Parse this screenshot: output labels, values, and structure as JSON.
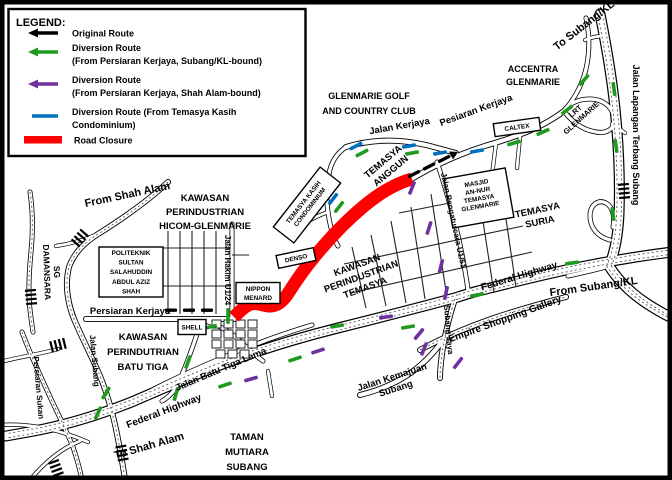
{
  "title": "Road Closure and Diversion Routes Map",
  "colors": {
    "original_route": "#000000",
    "diversion_subang_kl_bound": "#1F9A1F",
    "diversion_shah_alam_bound": "#7030A0",
    "diversion_temasya_kasih": "#0070C0",
    "road_closure": "#FF0000",
    "road_outline": "#000000",
    "background": "#FFFFFF"
  },
  "legend": {
    "heading": "LEGEND:",
    "items": [
      {
        "swatch": "black-arrow",
        "color": "#000000",
        "line1": "Original Route",
        "line2": ""
      },
      {
        "swatch": "green-arrow",
        "color": "#1F9A1F",
        "line1": "Diversion Route",
        "line2": "(From Persiaran Kerjaya, Subang/KL-bound)"
      },
      {
        "swatch": "purple-arrow",
        "color": "#7030A0",
        "line1": "Diversion Route",
        "line2": "(From Persiaran Kerjaya, Shah Alam-bound)"
      },
      {
        "swatch": "blue-line",
        "color": "#0070C0",
        "line1": "Diversion Route (From Temasya Kasih",
        "line2": "Condominium)"
      },
      {
        "swatch": "red-bar",
        "color": "#FF0000",
        "line1": "Road Closure",
        "line2": ""
      }
    ]
  },
  "labels": {
    "to_subang_kl": "To Subang/KL",
    "accentra": "ACCENTRA\nGLENMARIE",
    "glenmarie_golf": "GLENMARIE GOLF\nAND COUNTRY CLUB",
    "jalan_kerjaya": "Jalan  Kerjaya",
    "pesiaran_kerjaya": "Pesiaran Kerjaya",
    "lrt_glenmarie": "LRT\nGLENMARIE",
    "jalan_lapangan": "Jalan Lapangan Terbang Subang",
    "temasya_anggun": "TEMASYA\nANGGUN",
    "jalan_pengaturcara": "Jalan Pengaturcara U1/51",
    "temasya_suria": "TEMASYA\nSURIA",
    "from_shah_alam": "From Shah Alam",
    "hicom": "KAWASAN\nPERINDUSTRIAN\nHICOM-GLENMARIE",
    "sg_damansara": "SG\nDAMANSARA",
    "jalan_hakim": "Jalan Hakim U1/24",
    "persiaran_kerjaya": "Persiaran Kerjaya",
    "batu_tiga": "KAWASAN\nPERINDUTRIAN\nBATU TIGA",
    "persiaran_sukan": "Persiaran Sukan",
    "jalan_subang": "Jalan Subang",
    "batu_tiga_lama": "Jalan Batu Tiga Lama",
    "federal_highway_left": "Federal Highway",
    "to_shah_alam": "To Shah Alam",
    "taman_mutiara": "TAMAN\nMUTIARA\nSUBANG",
    "kawasan_temasya": "KAWASAN\nPERINDUSTRIAN\nTEMASYA",
    "federal_highway_right": "Federal Highway",
    "from_subang_kl": "From Subang/KL",
    "empire": "Empire Shopping Gallery",
    "subang_jaya": "Subang Jaya",
    "jalan_kemajuan": "Jalan Kemajuan\nSubang"
  },
  "pois": {
    "politeknik": "POLITEKNIK\nSULTAN\nSALAHUDDIN\nABDUL AZIZ\nSHAH",
    "shell": "SHELL",
    "nippon": "NIPPON\nMENARD",
    "denso": "DENSO",
    "caltex": "CALTEX",
    "condo": "TEMASYA KASIH\nCONDOMINIUM",
    "masjid": "MASJID\nAN-NUR\nTEMASYA\nGLENMARIE"
  }
}
